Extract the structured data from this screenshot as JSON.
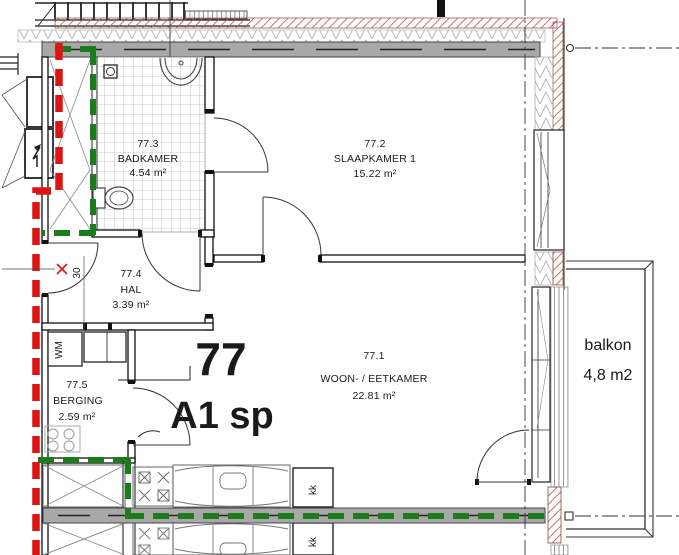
{
  "unit": {
    "number": "77",
    "type": "A1 sp"
  },
  "rooms": [
    {
      "number": "77.1",
      "name": "WOON- / EETKAMER",
      "area": "22.81 m²"
    },
    {
      "number": "77.2",
      "name": "SLAAPKAMER 1",
      "area": "15.22 m²"
    },
    {
      "number": "77.3",
      "name": "BADKAMER",
      "area": "4.54 m²"
    },
    {
      "number": "77.4",
      "name": "HAL",
      "area": "3.39 m²"
    },
    {
      "number": "77.5",
      "name": "BERGING",
      "area": "2.59 m²"
    }
  ],
  "balcony": {
    "label": "balkon",
    "area": "4,8 m2"
  },
  "fixtures": {
    "washing_machine": "WM",
    "fridge": "kk",
    "dimension": "30"
  },
  "colors": {
    "boundary_red": "#e01313",
    "boundary_green": "#1c7c1c",
    "wall_gray": "#a8a8a8",
    "hatch_red": "#c0504d"
  }
}
